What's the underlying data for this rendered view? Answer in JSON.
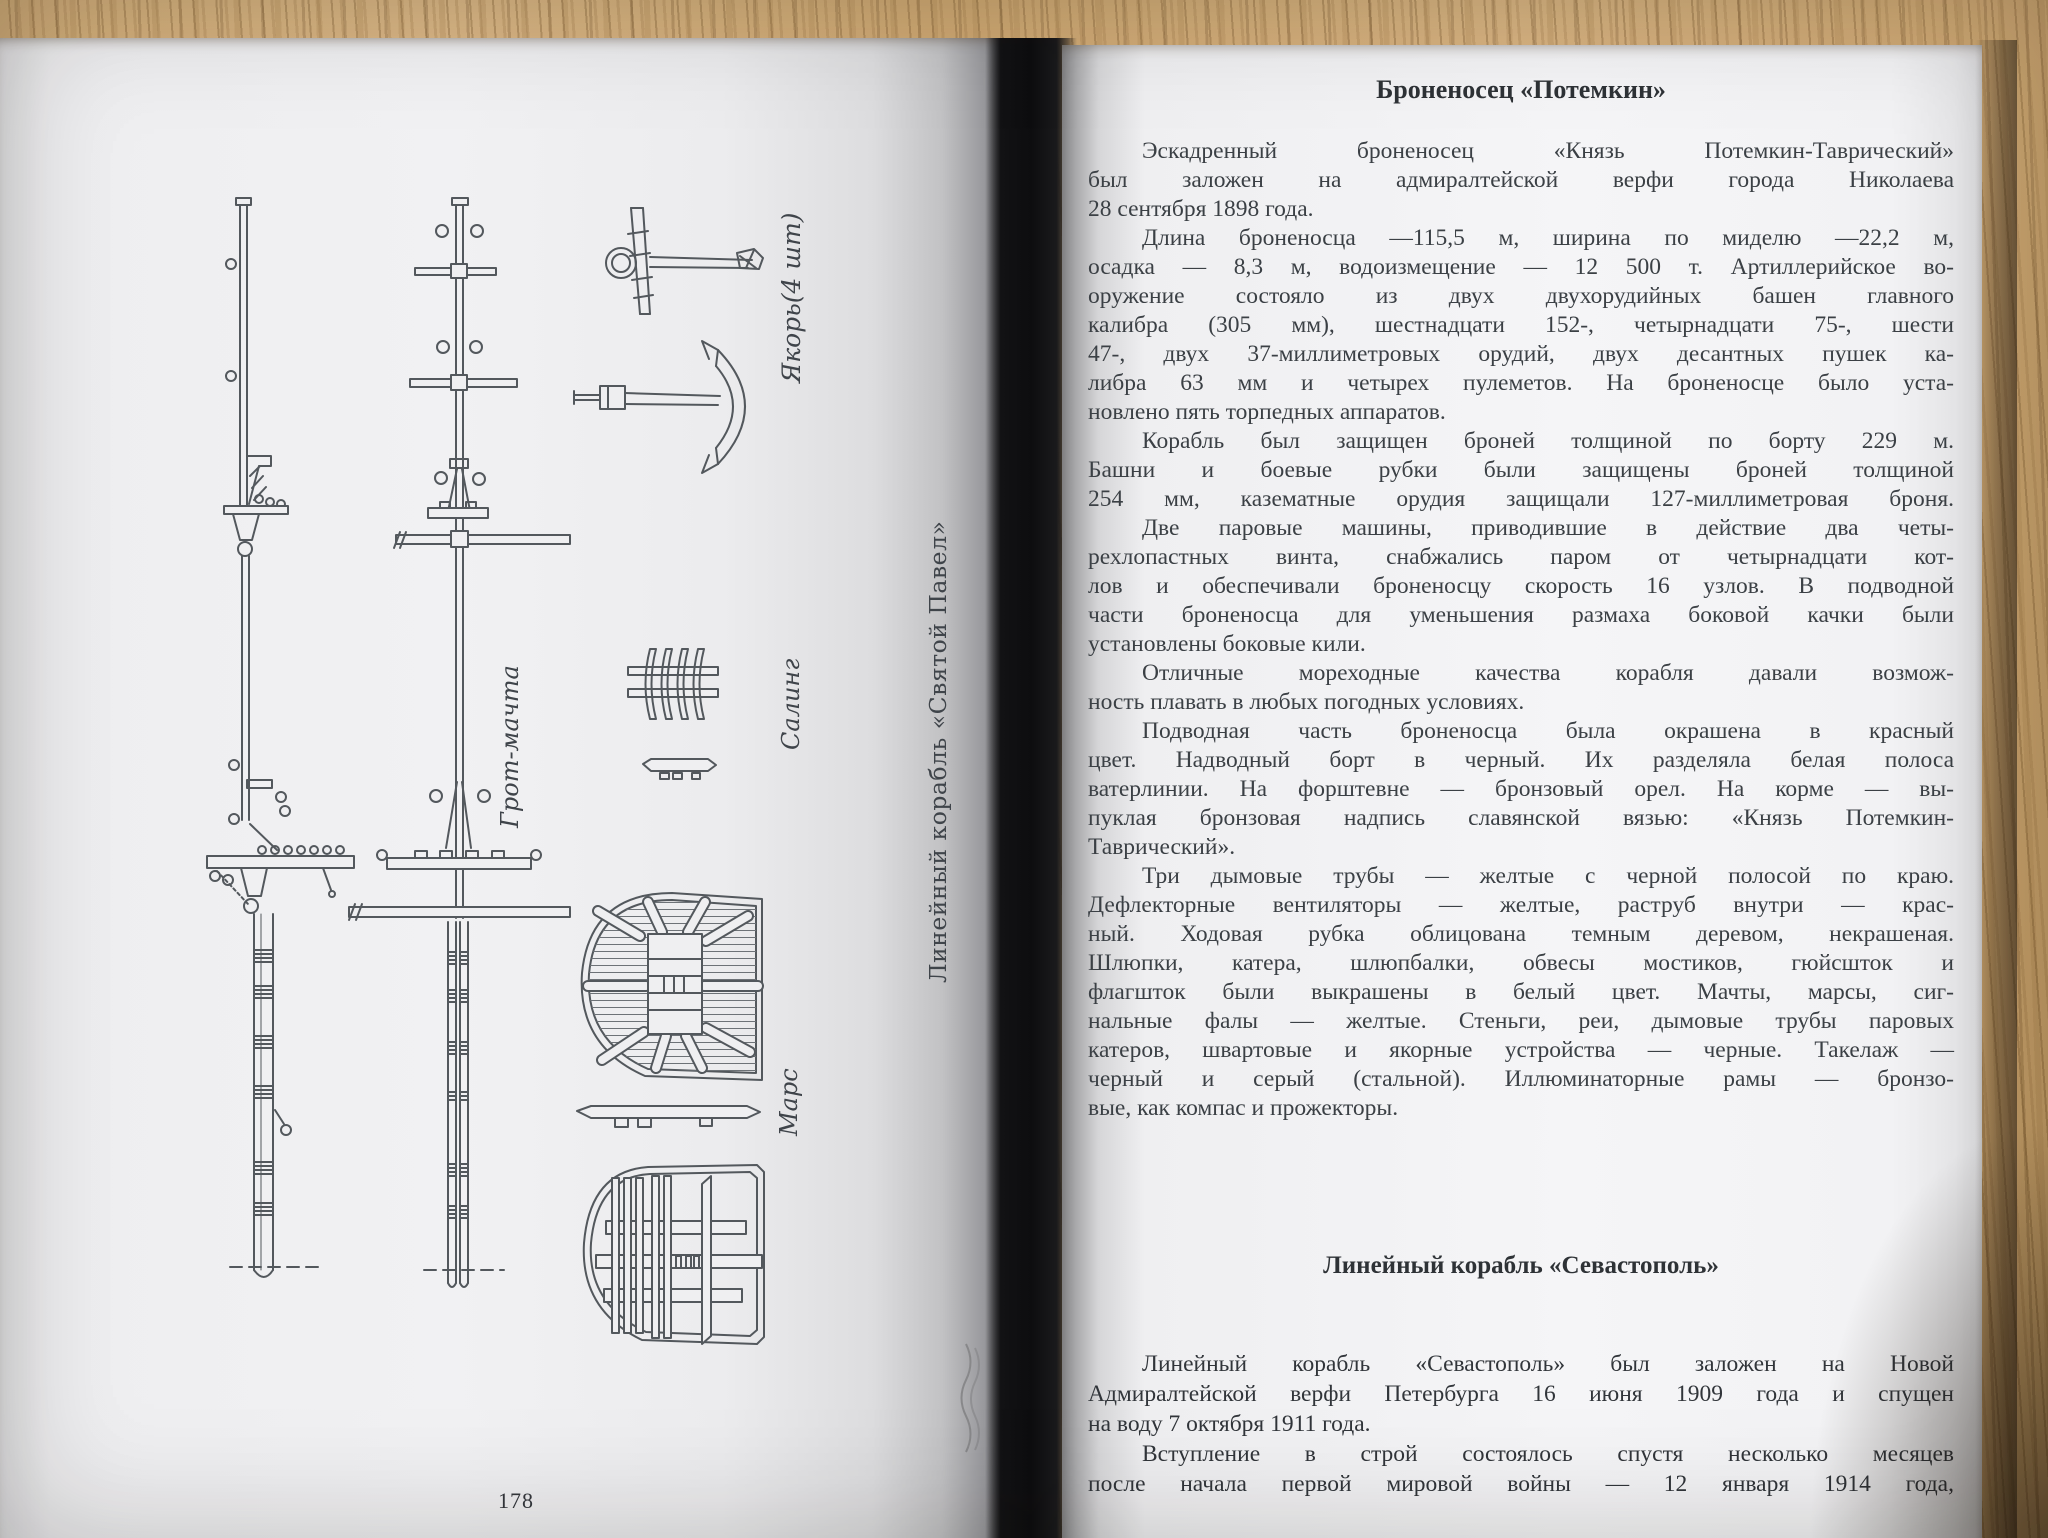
{
  "palette": {
    "wood": "#d4ad76",
    "wood_streak": "#7d582a",
    "paper_left": "#ececee",
    "paper_right": "#f4f4f6",
    "ink": "#3b4045",
    "gutter_shadow": "#0d0d0f"
  },
  "book": {
    "left_page": {
      "page_number": "178",
      "figure_labels": {
        "anchor": "Якорь(4 шт)",
        "saling": "Салинг",
        "mars": "Марс",
        "grot_machta": "Грот-мачта",
        "caption": "Линейный корабль «Святой Павел»"
      }
    },
    "right_page": {
      "page_number": "179",
      "title": "Броненосец «Потемкин»",
      "p1": [
        "Эскадренный броненосец «Князь Потемкин-Таврический»",
        "был заложен на адмиралтейской верфи города Николаева",
        "28 сентября 1898 года."
      ],
      "p2": [
        "Длина броненосца —115,5 м, ширина по миделю —22,2 м,",
        "осадка — 8,3 м, водоизмещение — 12 500 т. Артиллерийское во-",
        "оружение состояло из двух двухорудийных башен главного",
        "калибра (305 мм), шестнадцати 152-, четырнадцати 75-, шести",
        "47-, двух 37-миллиметровых орудий, двух десантных пушек ка-",
        "либра 63 мм и четырех пулеметов. На броненосце было уста-",
        "новлено пять торпедных аппаратов."
      ],
      "p3": [
        "Корабль был защищен броней толщиной по борту 229 м.",
        "Башни и боевые рубки были защищены броней толщиной",
        "254 мм, казематные орудия защищали 127-миллиметровая броня."
      ],
      "p4": [
        "Две паровые машины, приводившие в действие два четы-",
        "рехлопастных винта, снабжались паром от четырнадцати кот-",
        "лов и обеспечивали броненосцу скорость 16 узлов. В подводной",
        "части броненосца для уменьшения размаха боковой качки были",
        "установлены боковые кили."
      ],
      "p5": [
        "Отличные мореходные качества корабля давали возмож-",
        "ность плавать в любых погодных условиях."
      ],
      "p6": [
        "Подводная часть броненосца была окрашена в красный",
        "цвет. Надводный борт в черный. Их разделяла белая полоса",
        "ватерлинии. На форштевне — бронзовый орел. На корме — вы-",
        "пуклая бронзовая надпись славянской вязью: «Князь Потемкин-",
        "Таврический»."
      ],
      "p7": [
        "Три дымовые трубы — желтые с черной полосой по краю.",
        "Дефлекторные вентиляторы — желтые, раструб внутри — крас-",
        "ный. Ходовая рубка облицована темным деревом, некрашеная.",
        "Шлюпки, катера, шлюпбалки, обвесы мостиков, гюйсшток и",
        "флагшток были выкрашены в белый цвет. Мачты, марсы, сиг-",
        "нальные фалы — желтые. Стеньги, реи, дымовые трубы паровых",
        "катеров, швартовые и якорные устройства — черные. Такелаж —",
        "черный и серый (стальной). Иллюминаторные рамы — бронзо-",
        "вые, как компас и прожекторы."
      ],
      "section2_title": "Линейный корабль «Севастополь»",
      "p8": [
        "Линейный корабль «Севастополь» был заложен на Новой",
        "Адмиралтейской верфи Петербурга 16 июня 1909 года и спущен",
        "на воду 7 октября 1911 года."
      ],
      "p9": [
        "Вступление в строй состоялось спустя несколько месяцев",
        "после начала первой мировой войны — 12 января 1914 года,"
      ]
    }
  }
}
